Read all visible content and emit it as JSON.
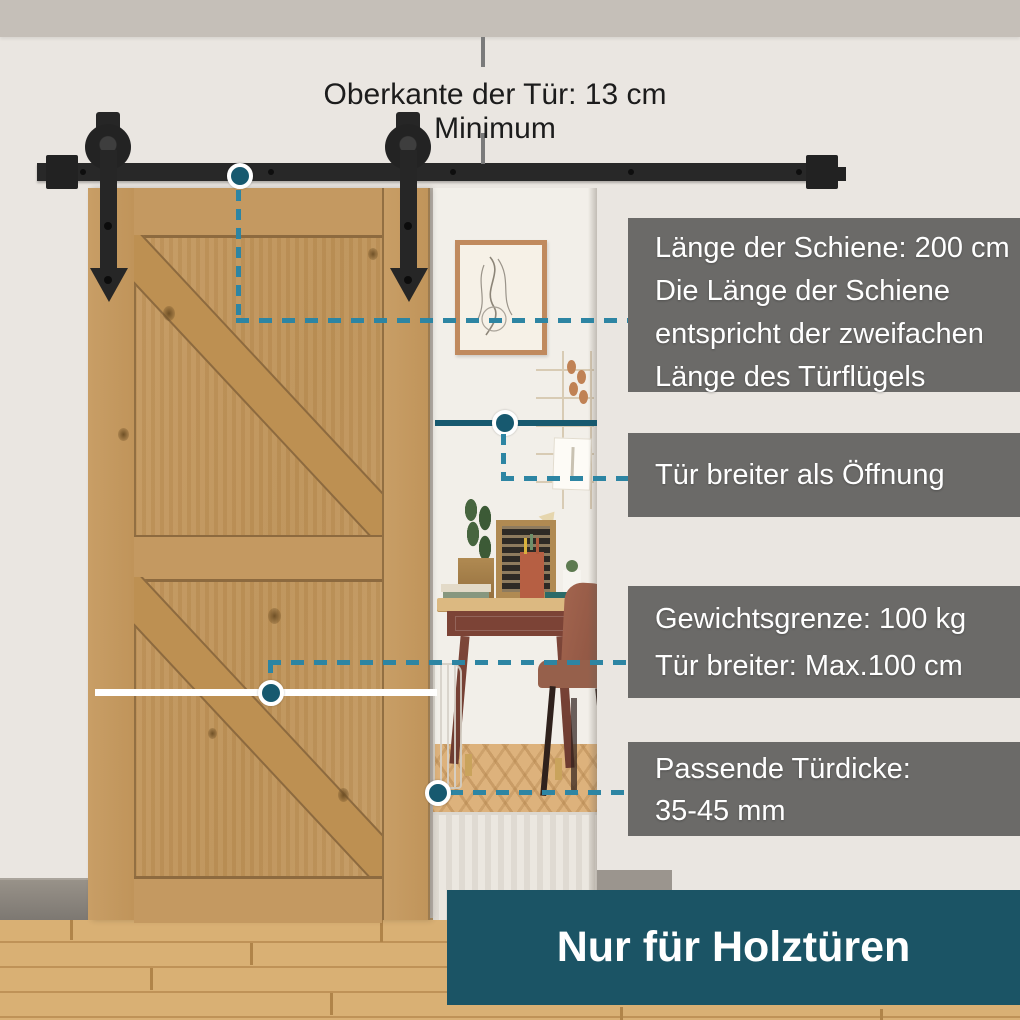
{
  "scene": {
    "top_note": "Oberkante der Tür: 13 cm Minimum",
    "footer_banner": "Nur für Holztüren"
  },
  "callouts": {
    "track_length": {
      "lines": [
        "Länge der Schiene: 200 cm",
        "Die Länge der Schiene",
        "entspricht der zweifachen",
        "Länge des Türflügels"
      ]
    },
    "opening": {
      "lines": [
        "Tür breiter als Öffnung"
      ]
    },
    "weight": {
      "lines": [
        "Gewichtsgrenze: 100 kg",
        "Tür breiter: Max.100 cm"
      ]
    },
    "thickness": {
      "lines": [
        "Passende Türdicke:",
        "35-45 mm"
      ]
    }
  },
  "measurements": {
    "top_clearance": "13 cm Minimum",
    "track_length": "200 cm",
    "weight_limit": "100 kg",
    "max_door_width": "100 cm",
    "door_thickness": "35-45 mm"
  },
  "colors": {
    "accent_teal": "#1b5465",
    "panel_gray": "#6b6a68",
    "dash_blue": "#2d85a3",
    "line_teal": "#17596f",
    "door_wood": "#c29760",
    "hardware_black": "#262626",
    "wall": "#eae6e1",
    "ceiling_band": "#c5bfb8",
    "floor_wood": "#d9b074"
  }
}
